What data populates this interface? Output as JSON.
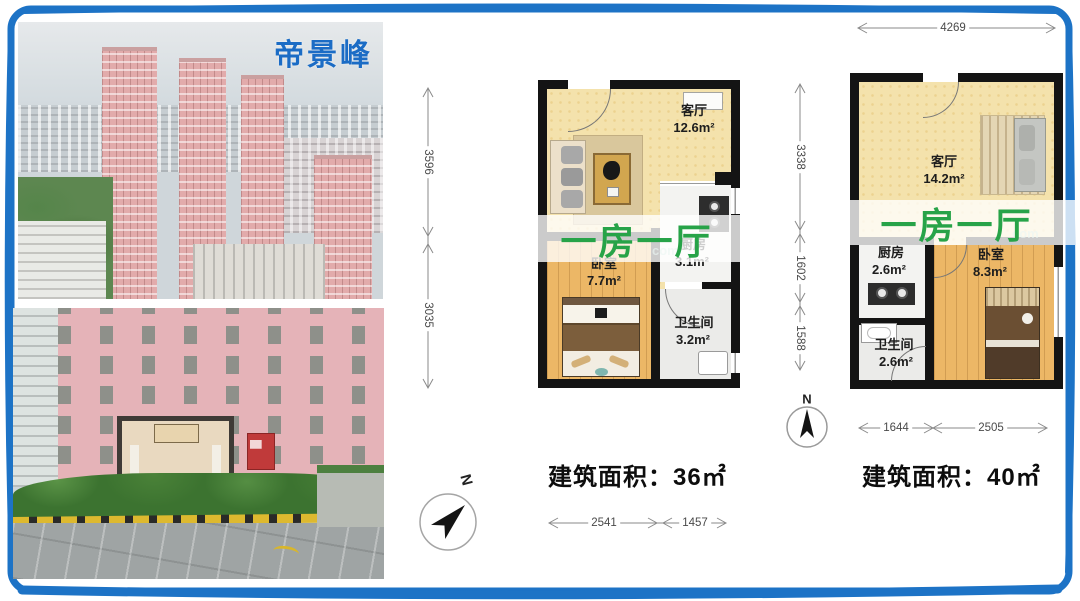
{
  "photos": {
    "top": {
      "caption": "帝景峰"
    }
  },
  "plans": [
    {
      "banner": "一房一厅",
      "area_total": "建筑面积：36㎡",
      "rooms": {
        "living": {
          "name": "客厅",
          "area": "12.6m²"
        },
        "kitchen": {
          "name": "厨房",
          "area": "3.1m²"
        },
        "bedroom": {
          "name": "卧室",
          "area": "7.7m²"
        },
        "bath": {
          "name": "卫生间",
          "area": "3.2m²"
        }
      },
      "dims": {
        "left_top": "3596",
        "left_bottom": "3035",
        "bottom_left": "2541",
        "bottom_right": "1457"
      },
      "compass_label": "N"
    },
    {
      "banner": "一房一厅",
      "area_total": "建筑面积：40㎡",
      "rooms": {
        "living": {
          "name": "客厅",
          "area": "14.2m²"
        },
        "kitchen": {
          "name": "厨房",
          "area": "2.6m²"
        },
        "bedroom": {
          "name": "卧室",
          "area": "8.3m²"
        },
        "bath": {
          "name": "卫生间",
          "area": "2.6m²"
        }
      },
      "dims": {
        "top": "4269",
        "left_top": "3338",
        "left_mid": "1602",
        "left_bottom": "1588",
        "bottom_left": "1644",
        "bottom_right": "2505"
      },
      "compass_label": "N"
    }
  ],
  "watermark": "com",
  "colors": {
    "accent_green": "#27a348",
    "title_blue": "#1b6cc5",
    "border_blue": "#1d73c6"
  }
}
